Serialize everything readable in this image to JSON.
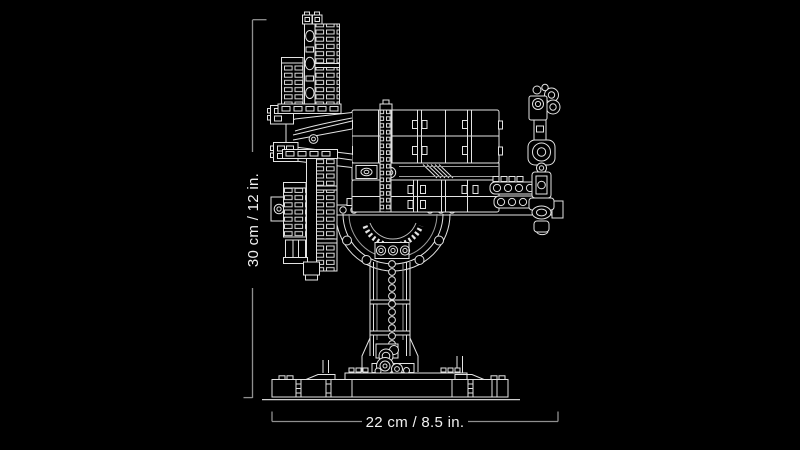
{
  "page": {
    "background": "#000000"
  },
  "artwork": {
    "graphic": "lego-model-on-stand-line-art",
    "line_color": "#e3e3e3",
    "dim_line_color": "#8f8f8f",
    "label_color": "#f1f1f1"
  },
  "dimensions": {
    "height_label": "30 cm / 12 in.",
    "width_label": "22 cm / 8.5 in."
  }
}
